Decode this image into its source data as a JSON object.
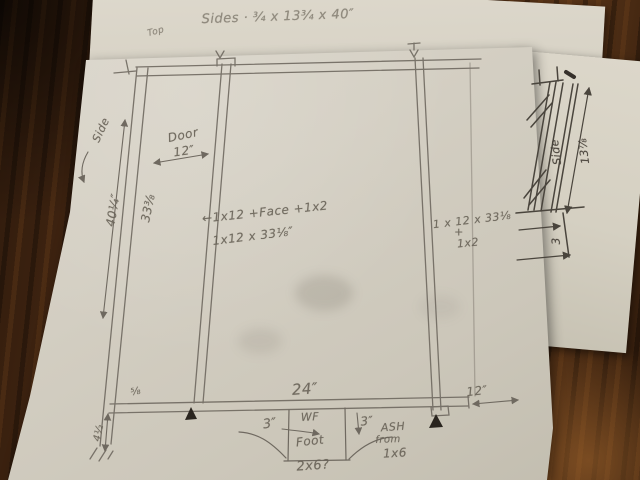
{
  "top_sheet": {
    "note": "Sides · ¾ x 13¾ x 40″",
    "mark": "Top"
  },
  "main_drawing": {
    "door_label": "Door",
    "door_width": "12″",
    "height_outer": "40¼″",
    "height_inner": "33⅜",
    "side_label": "Side",
    "center_note_line1": "←1x12 +Face +1x2",
    "center_note_line2": "1x12 x 33⅛″",
    "right_note_line1": "1 x 12 x 33⅛",
    "right_note_line2": "+",
    "right_note_line3": "1x2",
    "bottom_width": "24″",
    "right_bay_width": "12″",
    "foot_offset_left": "3″",
    "foot_block_line1": "WF",
    "foot_block_line2": "Foot",
    "foot_block_size": "2x6?",
    "foot_offset_right": "3″",
    "ash_note_line1": "ASH",
    "ash_note_line2": "from",
    "ash_note_line3": "1x6",
    "bottom_left_dim": "4½",
    "rail_width": "⅝"
  },
  "side_sketch": {
    "side_label": "Side",
    "height_dim": "13⅞",
    "toe_dim": "3"
  },
  "colors": {
    "pencil": "#6f6960",
    "dark_pencil": "#4a453d",
    "paper": "#d6d1c5",
    "wood": "#46280f"
  }
}
